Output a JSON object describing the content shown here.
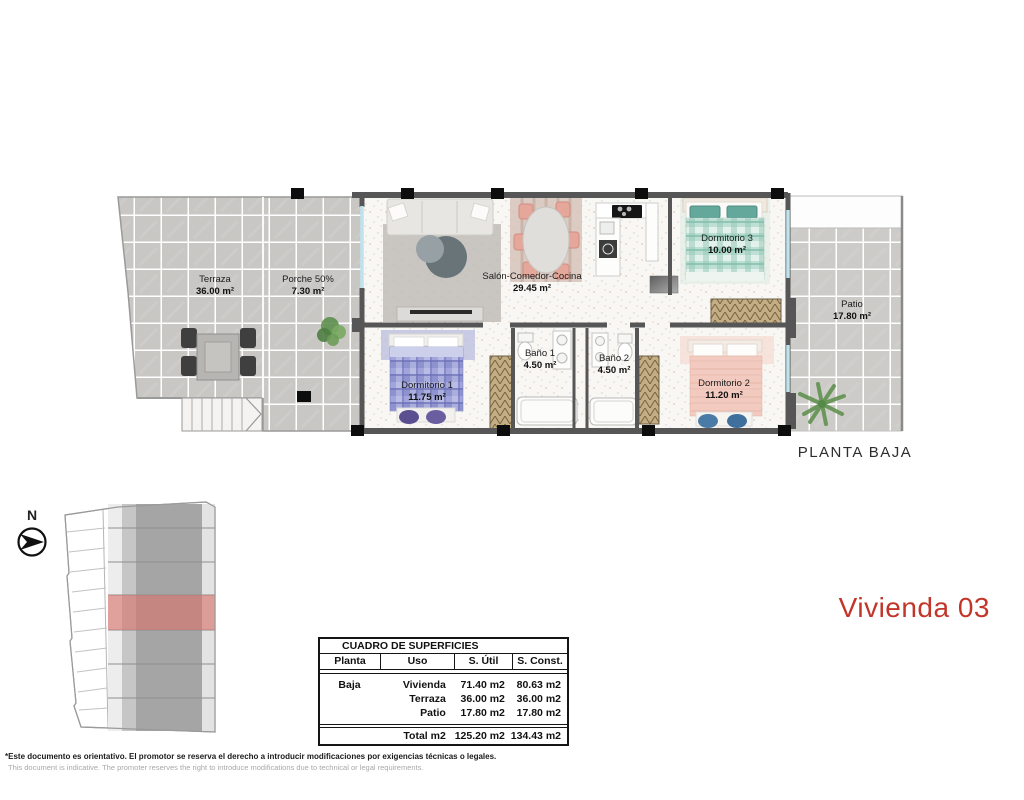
{
  "plan": {
    "title": "PLANTA BAJA",
    "rooms": [
      {
        "name": "Terraza",
        "area": "36.00 m²"
      },
      {
        "name": "Porche 50%",
        "area": "7.30 m²"
      },
      {
        "name": "Salón-Comedor-Cocina",
        "area": "29.45 m²"
      },
      {
        "name": "Dormitorio 3",
        "area": "10.00 m²"
      },
      {
        "name": "Patio",
        "area": "17.80 m²"
      },
      {
        "name": "Dormitorio 1",
        "area": "11.75 m²"
      },
      {
        "name": "Baño 1",
        "area": "4.50 m²"
      },
      {
        "name": "Baño 2",
        "area": "4.50 m²"
      },
      {
        "name": "Dormitorio 2",
        "area": "11.20 m²"
      }
    ]
  },
  "unit_title": "Vivienda 03",
  "compass": {
    "label": "N"
  },
  "surfaces_table": {
    "title": "CUADRO DE SUPERFICIES",
    "columns": [
      "Planta",
      "Uso",
      "S. Útil",
      "S. Const."
    ],
    "rows": [
      {
        "planta": "Baja",
        "uso": "Vivienda",
        "util": "71.40 m2",
        "const": "80.63 m2"
      },
      {
        "planta": "",
        "uso": "Terraza",
        "util": "36.00 m2",
        "const": "36.00 m2"
      },
      {
        "planta": "",
        "uso": "Patio",
        "util": "17.80 m2",
        "const": "17.80 m2"
      }
    ],
    "total": {
      "planta": "",
      "label": "Total m2",
      "util": "125.20 m2",
      "const": "134.43 m2"
    }
  },
  "disclaimer": {
    "es": "*Este documento es orientativo. El promotor se reserva el derecho a introducir modificaciones por exigencias técnicas o legales.",
    "en": "This document is indicative. The promoter reserves the right to introduce modifications due to technical or legal requirements."
  },
  "colors": {
    "accent_red": "#c2362a",
    "site_highlight": "#d9736a",
    "wall": "#565656",
    "tile": "#c9c7c4",
    "bed_blue": "#8e93d0",
    "bed_teal": "#bedfd3",
    "bed_pink": "#f2cac0"
  }
}
